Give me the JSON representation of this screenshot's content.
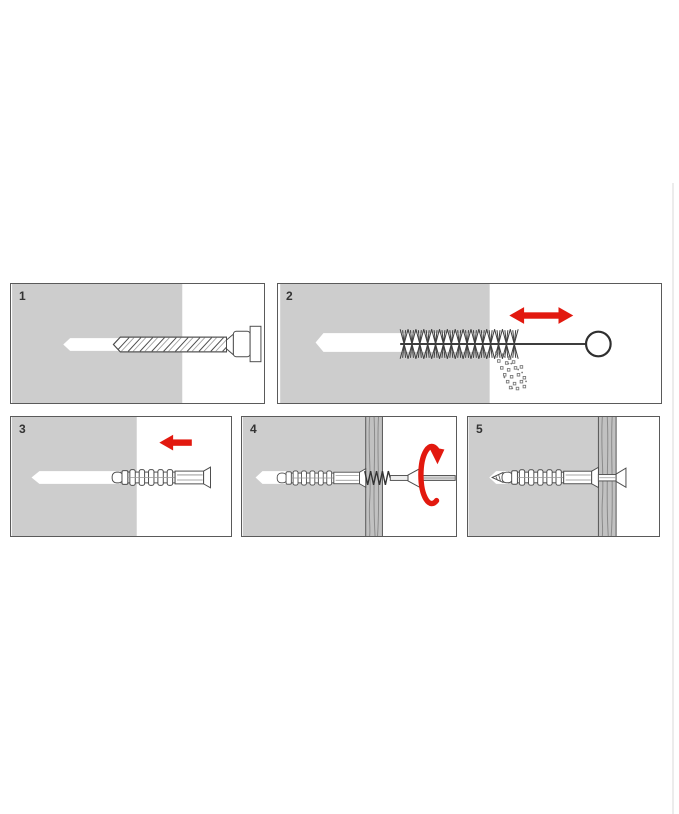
{
  "steps": [
    {
      "number": "1",
      "illustration": "drill-bit-drilling-hole"
    },
    {
      "number": "2",
      "illustration": "brush-cleaning-hole-with-dust"
    },
    {
      "number": "3",
      "illustration": "wall-anchor-being-inserted"
    },
    {
      "number": "4",
      "illustration": "screw-driven-through-batten-into-anchor"
    },
    {
      "number": "5",
      "illustration": "finished-flush-installation"
    }
  ],
  "colors": {
    "accent_red": "#e2190f",
    "wall_gray": "#cdcdcd",
    "batten_gray": "#c1c1c1",
    "outline_gray": "#4d4d4d",
    "panel_border": "#5a5a5a",
    "step_number": "#333333",
    "page_divider": "#ececec"
  }
}
